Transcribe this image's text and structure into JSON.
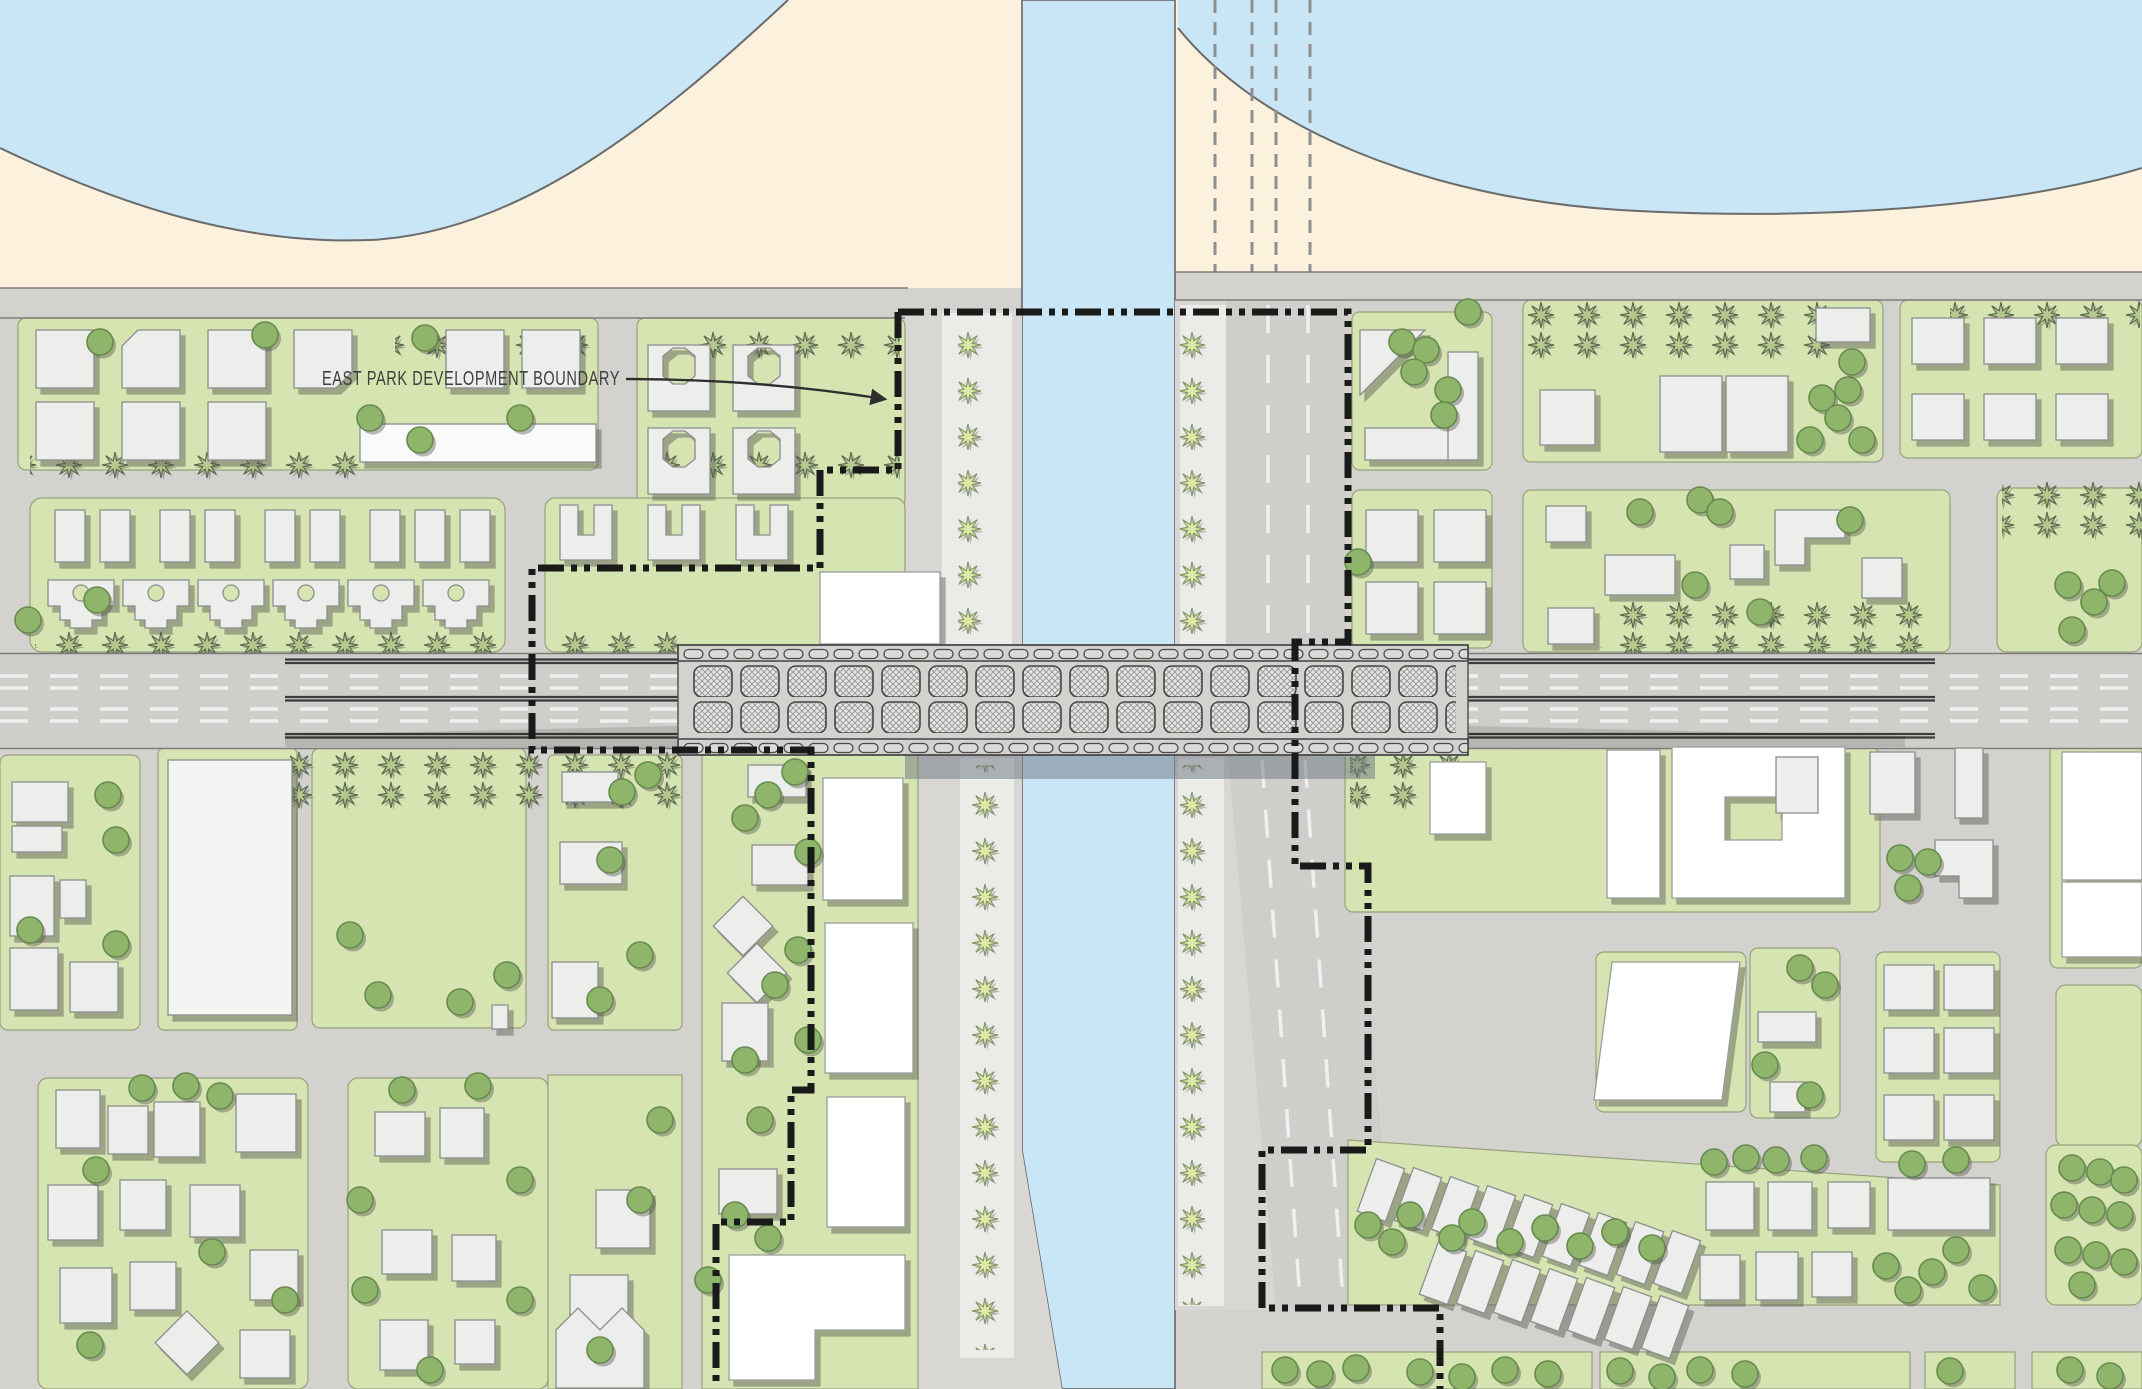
{
  "map": {
    "label": {
      "text": "EAST PARK DEVELOPMENT BOUNDARY"
    },
    "colors": {
      "sand": "#fbf1dc",
      "water": "#c9e6f6",
      "land": "#d3d2ce",
      "road": "#cfcecb",
      "parcel": "#d6e4b2",
      "parcel-edge": "#98a17d",
      "building": "#ededeb",
      "building-stroke": "#8d8d8d",
      "building-hl": "#ffffff",
      "tree": "#8fb56b",
      "tree-stroke": "#678a4f",
      "palm-dark": "#b5c98e",
      "palm-dark-stroke": "#5e6950",
      "palm-light": "#dfe9a6",
      "palm-light-stroke": "#87966a",
      "boundary": "#1a1a1a",
      "label-text": "#3f3f3f",
      "lane-marking": "#f4f4f2",
      "rail-line": "#3c3c3c",
      "shadow": "#55564f",
      "under-bridge-shadow": "#6b7680"
    },
    "icons": {
      "palm-tree-icon": "8-point star glyph",
      "round-tree-icon": "filled circle",
      "arrow-icon": "leader arrowhead"
    }
  }
}
